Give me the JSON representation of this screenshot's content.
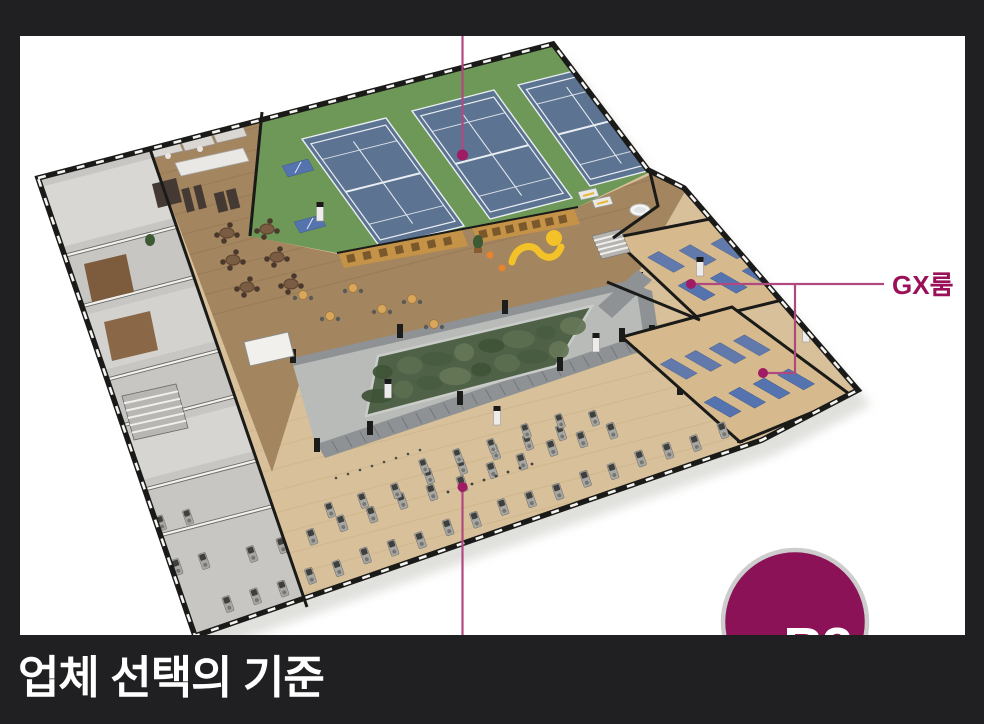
{
  "page": {
    "bg": "#202022"
  },
  "panel": {
    "bg": "#ffffff"
  },
  "footer": {
    "title": "업체 선택의 기준",
    "color": "#ffffff"
  },
  "badge": {
    "label": "B2",
    "fill": "#8c1257",
    "ring": "#cdcdcd",
    "label_color": "#ffffff"
  },
  "callouts": {
    "gx_room": {
      "label": "GX룸"
    },
    "line_color": "#b0497f",
    "dot_color": "#9f1b63",
    "label_color": "#9b1159"
  },
  "floorplan": {
    "palette": {
      "wood_light": "#d8c19a",
      "wood_dark": "#a3855f",
      "room_gray": "#c7c6c3",
      "green_floor": "#6e9857",
      "court_blue": "#5d7392",
      "court_line": "#e9eef3",
      "platform": "#b8bbb8",
      "hedge": "#4f6147",
      "cabinet": "#8e9294",
      "gx_wood": "#d6ba8e",
      "mat_blue": "#5573af",
      "wall": "#1a1a19",
      "wall_top": "#f6f5f2",
      "shelf": "#c49347",
      "accent_yellow": "#f3c229",
      "accent_orange": "#e8832e"
    }
  }
}
